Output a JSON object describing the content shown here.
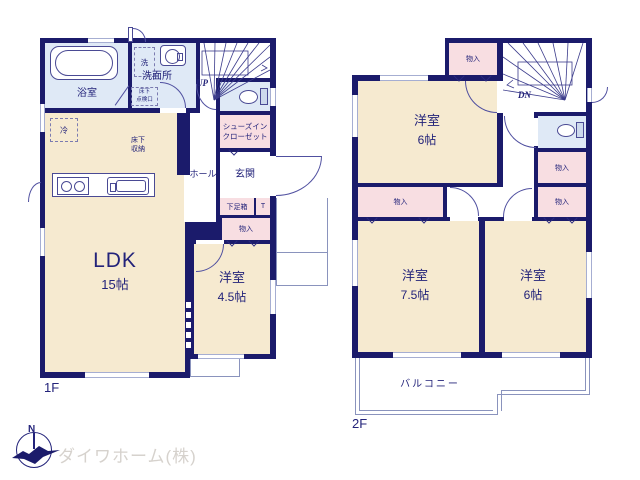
{
  "floor1": {
    "floor_label": "1F",
    "bath": "浴室",
    "washer": "洗",
    "washroom": "洗面所",
    "inspection_l1": "床下",
    "inspection_l2": "点検口",
    "up": "UP",
    "fridge": "冷",
    "underfloor_l1": "床下",
    "underfloor_l2": "収納",
    "hall": "ホール",
    "entrance": "玄関",
    "sic_l1": "シューズイン",
    "sic_l2": "クローゼット",
    "shoebox": "下足箱",
    "toilet_t": "T",
    "ldk": "LDK",
    "ldk_size": "15帖",
    "bedroom_size": "4.5帖"
  },
  "floor2": {
    "floor_label": "2F",
    "dn": "DN",
    "bedroom_top_size": "6帖",
    "bedroom_left_size": "7.5帖",
    "bedroom_right_size": "6帖",
    "balcony": "バルコニー"
  },
  "common": {
    "storage": "物入",
    "bedroom": "洋室"
  },
  "logo": {
    "north": "N",
    "company": "ダイワホーム(株)"
  },
  "colors": {
    "wall": "#1b1b6b",
    "room_cream": "#f6ead0",
    "closet_pink": "#f8dee2",
    "wet_blue": "#dfe9f6",
    "text_navy": "#23237a",
    "window_line": "#a6aed2",
    "thin_line": "#8a93bd",
    "logo_gray": "#d6d2cd"
  }
}
